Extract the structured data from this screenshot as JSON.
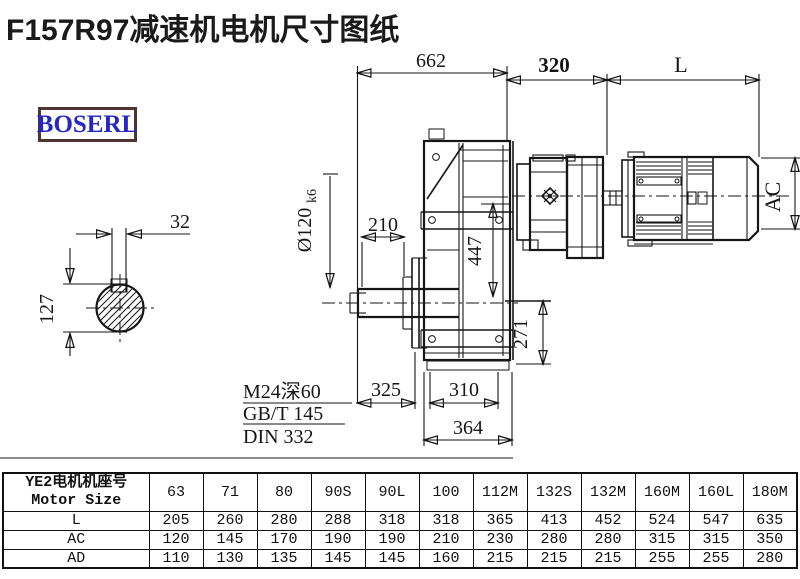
{
  "title": "F157R97减速机电机尺寸图纸",
  "logo": {
    "text": "BOSERL"
  },
  "drawing": {
    "dimensions": {
      "d662": "662",
      "d320": "320",
      "dL": "L",
      "d32": "32",
      "d127": "127",
      "d210": "210",
      "dia": "Ø120",
      "dia_tol": "k6",
      "d447": "447",
      "d271": "271",
      "d325": "325",
      "d310": "310",
      "d364": "364",
      "dAC": "AC"
    },
    "notes": [
      "M24深60",
      "GB/T 145",
      "DIN 332"
    ]
  },
  "table": {
    "header": {
      "label_line1": "YE2电机机座号",
      "label_line2": "Motor Size",
      "columns": [
        "63",
        "71",
        "80",
        "90S",
        "90L",
        "100",
        "112M",
        "132S",
        "132M",
        "160M",
        "160L",
        "180M"
      ]
    },
    "rows": [
      {
        "label": "L",
        "values": [
          "205",
          "260",
          "280",
          "288",
          "318",
          "318",
          "365",
          "413",
          "452",
          "524",
          "547",
          "635"
        ]
      },
      {
        "label": "AC",
        "values": [
          "120",
          "145",
          "170",
          "190",
          "190",
          "210",
          "230",
          "280",
          "280",
          "315",
          "315",
          "350"
        ]
      },
      {
        "label": "AD",
        "values": [
          "110",
          "130",
          "135",
          "145",
          "145",
          "160",
          "215",
          "215",
          "215",
          "255",
          "255",
          "280"
        ]
      }
    ]
  }
}
